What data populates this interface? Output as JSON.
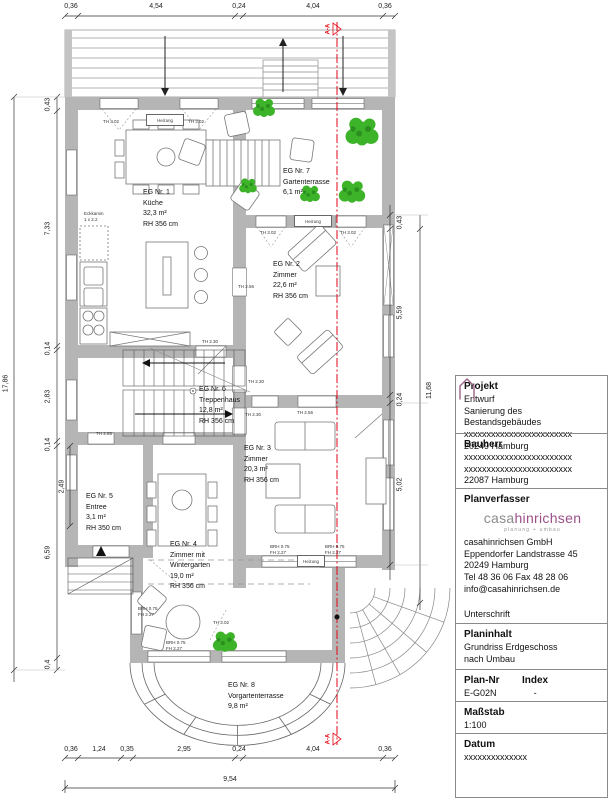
{
  "dimensions": {
    "top": [
      "0,36",
      "4,54",
      "0,24",
      "4,04",
      "0,36"
    ],
    "bottom": [
      "0,36",
      "1,24",
      "0,35",
      "2,95",
      "0,24",
      "4,04",
      "0,36"
    ],
    "bottom_total": "9,54",
    "left": [
      "0,43",
      "7,33",
      "0,14",
      "2,83",
      "0,14",
      "6,59",
      "0,4"
    ],
    "left_total": "17,86",
    "left_sub": "2,49",
    "right": [
      "0,43",
      "5,59",
      "0,24",
      "5,02"
    ],
    "right_outer": "11,68"
  },
  "rooms": {
    "r1": "EG Nr. 1\nKüche\n32,3 m²\nRH 356 cm",
    "r2": "EG Nr. 2\nZimmer\n22,6 m²\nRH 356 cm",
    "r3": "EG Nr. 3\nZimmer\n20,3 m²\nRH 356 cm",
    "r4": "EG Nr. 4\nZimmer mit\nWintergarten\n19,0 m²\nRH 356 cm",
    "r5": "EG Nr. 5\nEntree\n3,1 m²\nRH 350 cm",
    "r6": "EG Nr. 6\nTreppenhaus\n12,8 m²\nRH 356 cm",
    "r7": "EG Nr. 7\nGartenterrasse\n6,1 m²",
    "r8": "EG Nr. 8\nVorgartenterrasse\n9,8 m²"
  },
  "annotations": {
    "eckkamin": "Eckkamin\n1 x 2.2",
    "th302": "TH 3.02",
    "th256": "TH 2.56",
    "th230": "TH 2.30",
    "th285": "TH 2.85",
    "heizung": "Heizung",
    "brh_fh": "BRH 0.75\nFH 2.27",
    "section": "A-A"
  },
  "title_block": {
    "projekt_label": "Projekt",
    "projekt": "Entwurf\nSanierung des Bestandsgebäudes\nxxxxxxxxxxxxxxxxxxxxxxxx\n20249 Hamburg",
    "bauherr_label": "Bauherr",
    "bauherr": "xxxxxxxxxxxxxxxxxxxxxxxx\nxxxxxxxxxxxxxxxxxxxxxxxx\n22087 Hamburg",
    "planverfasser_label": "Planverfasser",
    "logo_casa": "casa",
    "logo_hinrichsen": "hinrichsen",
    "logo_tagline": "planung + umbau",
    "address": "casahinrichsen GmbH\nEppendorfer Landstrasse 45\n20249 Hamburg\nTel 48 36 06  Fax 48 28 06\ninfo@casahinrichsen.de",
    "unterschrift_label": "Unterschrift",
    "planinhalt_label": "Planinhalt",
    "planinhalt": "Grundriss Erdgeschoss\nnach Umbau",
    "plannr_label": "Plan-Nr",
    "plannr": "E-G02N",
    "index_label": "Index",
    "index": "-",
    "massstab_label": "Maßstab",
    "massstab": "1:100",
    "datum_label": "Datum",
    "datum": "xxxxxxxxxxxxxx"
  },
  "colors": {
    "wall": "#b5b5b5",
    "plant": "#3db32a",
    "section_red": "#e30613",
    "logo_purple": "#9b4f87",
    "logo_gray": "#8a8a8a"
  }
}
